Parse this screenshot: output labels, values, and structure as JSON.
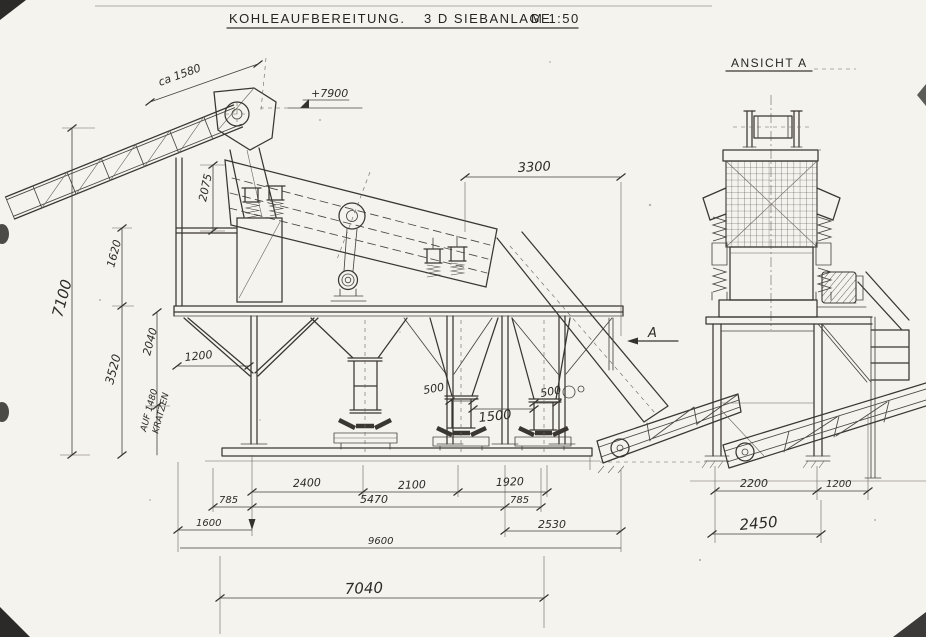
{
  "document": {
    "title_main": "KOHLEAUFBEREITUNG.",
    "title_sub": "3 D SIEBANLAGE",
    "title_scale": "M 1:50"
  },
  "labels": {
    "view": "ANSICHT A",
    "section_marker": "A",
    "elevation": "+7900",
    "conveyor_length_note": "ca 1580",
    "side_note_1": "AUF 1480",
    "side_note_2": "KRATZEN"
  },
  "dimensions": {
    "overall_height": "7100",
    "substructure_height": "3520",
    "brace_height": "2040",
    "feedbox_height": "1620",
    "screen_feed_height": "2075",
    "brace_offset": "1200",
    "screen_length": "3300",
    "chute_left_width": "500",
    "chute_spacing": "1500",
    "chute_right_width": "500",
    "bay_1": "2400",
    "bay_2": "2100",
    "bay_3": "1920",
    "overhang_left": "785",
    "frame_length": "5470",
    "overhang_right": "785",
    "ext_left": "1600",
    "ext_right": "2530",
    "overall_length": "9600",
    "base_length": "7040",
    "front_bay": "2200",
    "front_overhang": "1200",
    "front_base": "2450"
  }
}
